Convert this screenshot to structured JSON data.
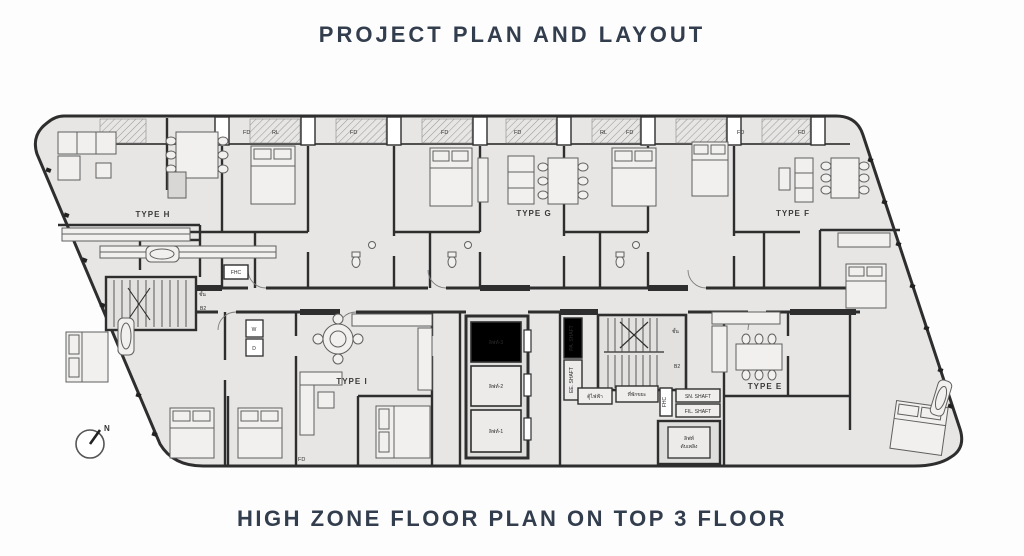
{
  "title": "PROJECT PLAN AND LAYOUT",
  "caption": "HIGH ZONE FLOOR PLAN ON TOP 3 FLOOR",
  "colors": {
    "heading": "#323d4e",
    "plan_fill": "#e7e6e4",
    "wall": "#2e2e2e"
  },
  "compass": {
    "north": "N"
  },
  "plan": {
    "units": [
      {
        "id": "type-h",
        "label": "TYPE H"
      },
      {
        "id": "type-g",
        "label": "TYPE G"
      },
      {
        "id": "type-f",
        "label": "TYPE F"
      },
      {
        "id": "type-i",
        "label": "TYPE I"
      },
      {
        "id": "type-e",
        "label": "TYPE E"
      }
    ],
    "lifts": [
      {
        "label": "ลิฟท์-3"
      },
      {
        "label": "ลิฟท์-2"
      },
      {
        "label": "ลิฟท์-1"
      }
    ],
    "fire_lift": {
      "line1": "ลิฟท์",
      "line2": "ดับเพลิง"
    },
    "shafts": {
      "pa": "PA. SHAFT",
      "ee": "EE. SHAFT",
      "sn": "SN. SHAFT",
      "fil": "FIL. SHAFT"
    },
    "service": {
      "electrical": "ตู้ไฟฟ้า",
      "refuse": "ที่พักขยะ",
      "fhc": "FHC"
    },
    "stair": {
      "floor": "ชั้น",
      "level": "B2"
    },
    "marks": {
      "fd": "FD",
      "rl": "RL",
      "washer": "W",
      "dryer": "D"
    }
  }
}
